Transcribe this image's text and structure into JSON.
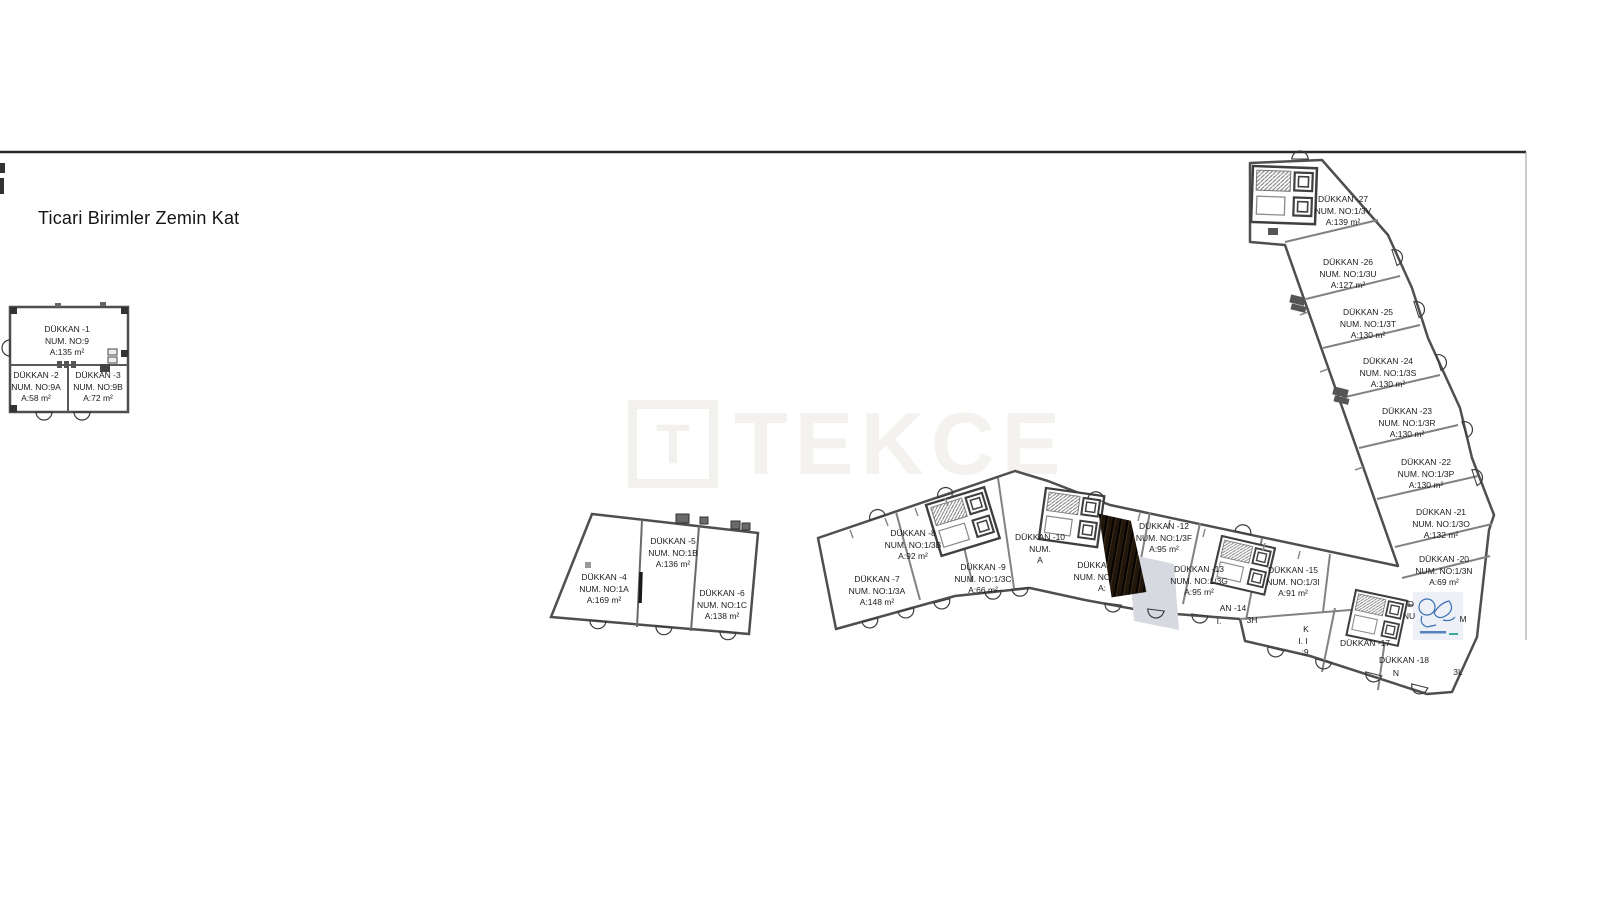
{
  "page": {
    "title": "Ticari Birimler Zemin Kat"
  },
  "watermark": {
    "t_letter": "T",
    "brand": "TEKCE"
  },
  "colors": {
    "wall": "#4f4f4f",
    "wall_light": "#828282",
    "dark_shaft": "#241a10",
    "ramp_gray": "#d6dae0",
    "stamp_blue": "#3a6fb5",
    "stamp_teal": "#2a9d8f",
    "watermark": "#f4f2ee"
  },
  "icons": {
    "door": "door-arc-icon",
    "stairs": "stairs-hatch-icon",
    "elevator": "elevator-box-icon",
    "stamp": "architect-stamp-icon"
  },
  "units": [
    {
      "name": "DÜKKAN -1",
      "num": "NUM. NO:9",
      "area": "A:135 m²",
      "x": 67,
      "y": 341
    },
    {
      "name": "DÜKKAN -2",
      "num": "NUM. NO:9A",
      "area": "A:58 m²",
      "x": 36,
      "y": 387
    },
    {
      "name": "DÜKKAN -3",
      "num": "NUM. NO:9B",
      "area": "A:72 m²",
      "x": 98,
      "y": 387
    },
    {
      "name": "DÜKKAN -4",
      "num": "NUM. NO:1A",
      "area": "A:169 m²",
      "x": 604,
      "y": 589
    },
    {
      "name": "DÜKKAN -5",
      "num": "NUM. NO:1B",
      "area": "A:136 m²",
      "x": 673,
      "y": 553
    },
    {
      "name": "DÜKKAN -6",
      "num": "NUM. NO:1C",
      "area": "A:138 m²",
      "x": 722,
      "y": 605
    },
    {
      "name": "DÜKKAN -7",
      "num": "NUM. NO:1/3A",
      "area": "A:148 m²",
      "x": 877,
      "y": 591
    },
    {
      "name": "DÜKKAN -8",
      "num": "NUM. NO:1/3B",
      "area": "A:92 m²",
      "x": 913,
      "y": 545
    },
    {
      "name": "DÜKKAN -9",
      "num": "NUM. NO:1/3C",
      "area": "A:66 m²",
      "x": 983,
      "y": 579
    },
    {
      "name": "DÜKKAN -10",
      "num": "NUM.",
      "area": "A",
      "x": 1040,
      "y": 549
    },
    {
      "name": "DÜKKAN -11",
      "num": "NUM. NO:1/3E",
      "area": "A:",
      "x": 1102,
      "y": 577
    },
    {
      "name": "DÜKKAN -12",
      "num": "NUM. NO:1/3F",
      "area": "A:95 m²",
      "x": 1164,
      "y": 538
    },
    {
      "name": "DÜKKAN -13",
      "num": "NUM. NO:1/3G",
      "area": "A:95 m²",
      "x": 1199,
      "y": 581
    },
    {
      "name": "DÜKKAN -15",
      "num": "NUM. NO:1/3I",
      "area": "A:91 m²",
      "x": 1293,
      "y": 582
    },
    {
      "name": "DÜKKAN -20",
      "num": "NUM. NO:1/3N",
      "area": "A:69 m²",
      "x": 1444,
      "y": 571
    },
    {
      "name": "DÜKKAN -21",
      "num": "NUM. NO:1/3O",
      "area": "A:132 m²",
      "x": 1441,
      "y": 524
    },
    {
      "name": "DÜKKAN -22",
      "num": "NUM. NO:1/3P",
      "area": "A:130 m²",
      "x": 1426,
      "y": 474
    },
    {
      "name": "DÜKKAN -23",
      "num": "NUM. NO:1/3R",
      "area": "A:130 m²",
      "x": 1407,
      "y": 423
    },
    {
      "name": "DÜKKAN -24",
      "num": "NUM. NO:1/3S",
      "area": "A:130 m²",
      "x": 1388,
      "y": 373
    },
    {
      "name": "DÜKKAN -25",
      "num": "NUM. NO:1/3T",
      "area": "A:130 m²",
      "x": 1368,
      "y": 324
    },
    {
      "name": "DÜKKAN -26",
      "num": "NUM. NO:1/3U",
      "area": "A:127 m²",
      "x": 1348,
      "y": 274
    },
    {
      "name": "DÜKKAN -27",
      "num": "NUM. NO:1/3V",
      "area": "A:139 m²",
      "x": 1343,
      "y": 211
    }
  ],
  "fragments": [
    {
      "text": "AN -14",
      "x": 1233,
      "y": 608
    },
    {
      "text": "I.",
      "x": 1219,
      "y": 621
    },
    {
      "text": "3H",
      "x": 1252,
      "y": 620
    },
    {
      "text": "K",
      "x": 1306,
      "y": 629
    },
    {
      "text": "I. I",
      "x": 1303,
      "y": 641
    },
    {
      "text": ":9",
      "x": 1305,
      "y": 652
    },
    {
      "text": "DÜKKAN -17",
      "x": 1365,
      "y": 643
    },
    {
      "text": "DÜKKAN -18",
      "x": 1404,
      "y": 660
    },
    {
      "text": "N",
      "x": 1396,
      "y": 673
    },
    {
      "text": "3L",
      "x": 1458,
      "y": 672
    },
    {
      "text": "D",
      "x": 1411,
      "y": 604
    },
    {
      "text": "NU",
      "x": 1409,
      "y": 616
    },
    {
      "text": "M",
      "x": 1463,
      "y": 619
    }
  ]
}
